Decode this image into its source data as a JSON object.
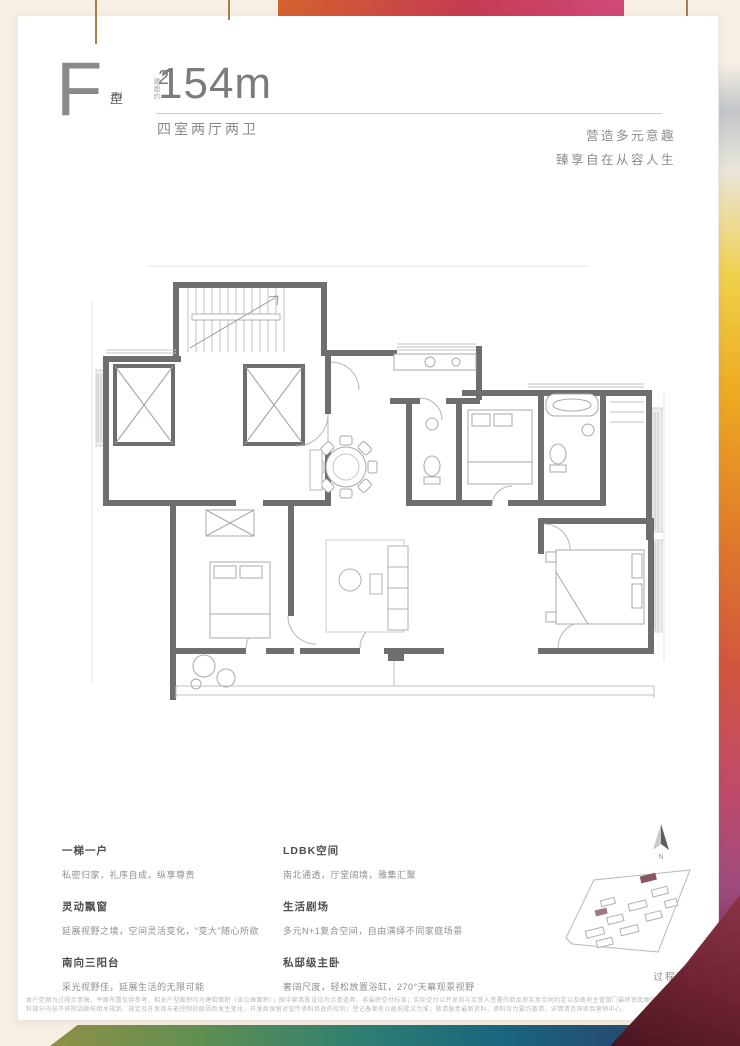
{
  "header": {
    "unit_letter": "F",
    "unit_type_char1": "户",
    "unit_type_char2": "型",
    "area_prefix": "建面约",
    "area_value": "154m",
    "area_sup": "2",
    "layout": "四室两厅两卫",
    "slogan_line1": "营造多元意趣",
    "slogan_line2": "臻享自在从容人生"
  },
  "features": {
    "left": [
      {
        "title": "一梯一户",
        "desc": "私密归家，礼序自成，纵享尊贵"
      },
      {
        "title": "灵动飘窗",
        "desc": "延展视野之境，空间灵活变化，“变大”随心所欲"
      },
      {
        "title": "南向三阳台",
        "desc": "采光视野佳，延展生活的无限可能"
      }
    ],
    "right": [
      {
        "title": "LDBK空间",
        "desc": "南北通透，厅堂阔境，雅集汇聚"
      },
      {
        "title": "生活剧场",
        "desc": "多元N+1复合空间，自由演绎不同家庭场景"
      },
      {
        "title": "私邸级主卧",
        "desc": "奢阔尺度，轻松放置浴缸，270°天幕观景视野"
      }
    ]
  },
  "compass": {
    "label": "N"
  },
  "footer": {
    "draft_label": "过程稿",
    "disclaimer_line1": "本户型图为过程示意稿，平面布置仅供参考，相关户型面积均为建筑面积（含公摊面积）；图中家具陈设均为示意道具，非最终交付标准；实际交付以开发商与买受人签署的商品房买卖合同约定以及政府主管部门最终审批图纸为准；本资",
    "disclaimer_line2": "料部分内容不排除因政府相关规划、规定及开发商未能控制的原因而发生变化，开发商保留对宣传资料修改的权利；登记备案名以政府批文为准；敬请留意最新资料，资料仅为要约邀请，详情请咨询项目营销中心。"
  },
  "colors": {
    "page_bg": "#f7efe4",
    "card_bg": "#ffffff",
    "wall_gray": "#6e6e6e",
    "accent_orange": "#e07b2a",
    "accent_crimson": "#c63b52",
    "maroon": "#6d2233",
    "band_teal": "#2e7f72"
  }
}
